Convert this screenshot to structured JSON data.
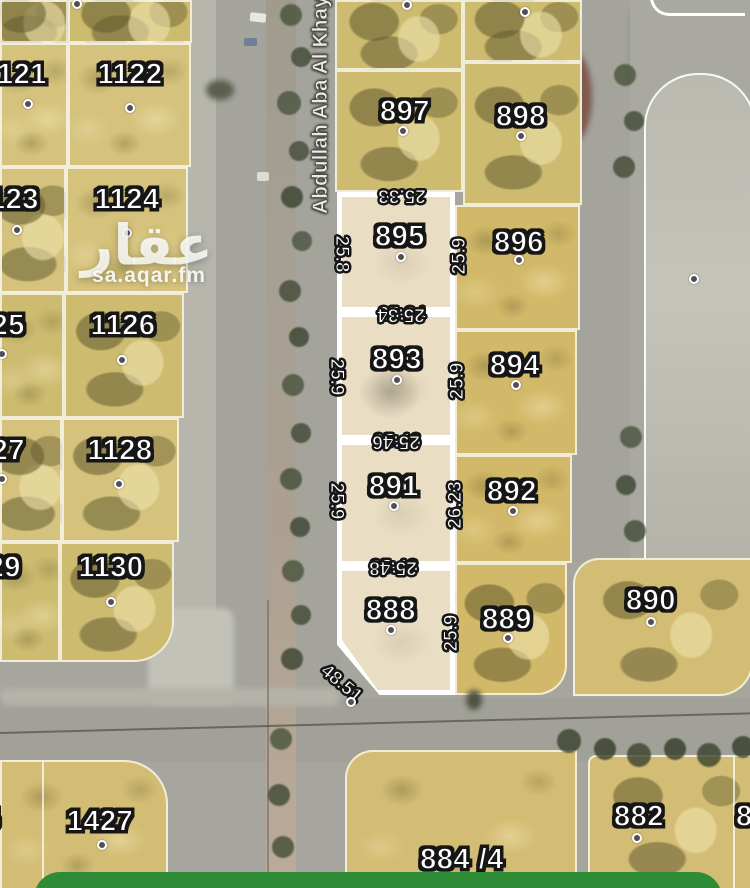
{
  "watermark": {
    "logo": "عقار",
    "site": "sa.aqar.fm"
  },
  "street": {
    "name": "Abdullah Aba Al Khay"
  },
  "colors": {
    "road_gray": "#a4a49c",
    "parcel_yellow": "#d5c27c",
    "highlight_cream": "#e9dec4",
    "boundary_white": "#ffffff",
    "action_green": "#2e8b36",
    "label_fill": "#ffffff",
    "label_outline": "#161616"
  },
  "left_block": {
    "parcels": [
      "1121",
      "1122",
      "1123",
      "1124",
      "1125",
      "1126",
      "1127",
      "1128",
      "1129",
      "1130"
    ]
  },
  "mid_block": {
    "parcels": [
      "897",
      "898",
      "896",
      "894",
      "892",
      "889"
    ]
  },
  "highlighted": {
    "parcels": [
      {
        "id": "895",
        "dim_top": "25.33",
        "dim_left": "25.8",
        "dim_right": "25.9",
        "dim_bottom": "25.34"
      },
      {
        "id": "893",
        "dim_left": "25.9",
        "dim_right": "25.9",
        "dim_bottom": "25.46"
      },
      {
        "id": "891",
        "dim_left": "25.9",
        "dim_right": "26.23",
        "dim_bottom": "25.48"
      },
      {
        "id": "888",
        "dim_right": "25.9",
        "dim_diagonal": "48.51"
      }
    ]
  },
  "right_block": {
    "parcels": [
      "890"
    ]
  },
  "bottom_blocks": {
    "parcels": [
      "1425",
      "1427",
      "884 /4",
      "882",
      "8"
    ]
  }
}
